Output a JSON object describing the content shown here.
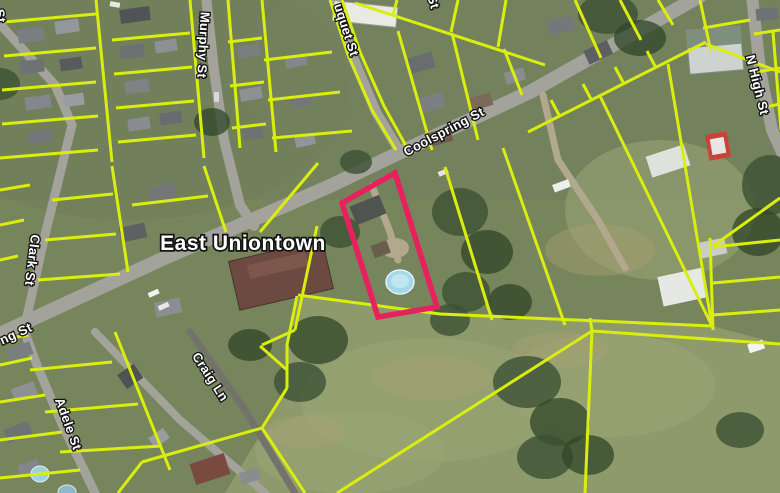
{
  "map": {
    "place_label": "East Uniontown",
    "street_labels": [
      {
        "id": "coolspring",
        "text": "Coolspring St"
      },
      {
        "id": "murphy",
        "text": "Murphy St"
      },
      {
        "id": "duquet_partial",
        "text": "uquet St"
      },
      {
        "id": "n_high",
        "text": "N High St"
      },
      {
        "id": "clark",
        "text": "Clark St"
      },
      {
        "id": "coolspring_edge_partial",
        "text": "ng St"
      },
      {
        "id": "adele",
        "text": "Adele St"
      },
      {
        "id": "craig",
        "text": "Craig Ln"
      },
      {
        "id": "top_left_partial",
        "text": "St"
      },
      {
        "id": "top_mid_partial",
        "text": "St"
      }
    ],
    "highlight_parcel": {
      "stroke": "#e8205e",
      "description": "selected parcel outlined in pink, contains round swimming pool"
    },
    "overlay": "yellow parcel boundary lines over aerial imagery"
  },
  "colors": {
    "parcel_yellow": "#d9ee0e",
    "highlight_pink": "#e8205e",
    "label_white": "#ffffff",
    "label_outline": "#141414",
    "road_gray": "#a3a29b",
    "pool_blue": "#a5d8e6"
  }
}
